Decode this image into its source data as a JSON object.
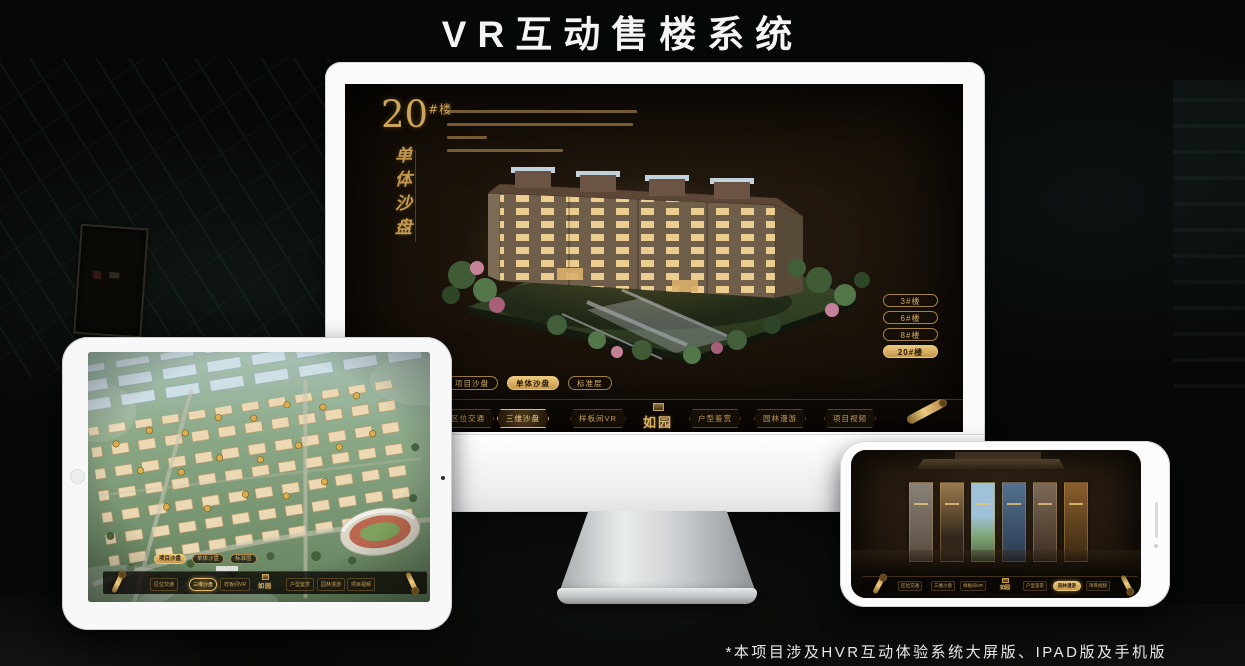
{
  "header": {
    "title": "VR互动售楼系统"
  },
  "footer": {
    "note": "*本项目涉及HVR互动体验系统大屏版、IPAD版及手机版"
  },
  "colors": {
    "gold": "#c9a158",
    "gold_bright": "#ecc87c",
    "dark_text": "#241806"
  },
  "monitor": {
    "unit_number": "20",
    "unit_suffix": "#楼",
    "vertical_title": "单体沙盘",
    "floor_buttons": [
      {
        "label": "3#楼",
        "active": false
      },
      {
        "label": "6#楼",
        "active": false
      },
      {
        "label": "8#楼",
        "active": false
      },
      {
        "label": "20#楼",
        "active": true
      }
    ],
    "mode_tabs": [
      {
        "label": "项目沙盘",
        "active": false
      },
      {
        "label": "单体沙盘",
        "active": true
      },
      {
        "label": "标准层",
        "active": false
      }
    ],
    "nav_items": [
      {
        "label": "区位交通",
        "active": false
      },
      {
        "label": "三维沙盘",
        "active": true
      },
      {
        "label": "样板间VR",
        "active": false
      },
      {
        "label": "户型鉴赏",
        "active": false
      },
      {
        "label": "园林漫游",
        "active": false
      },
      {
        "label": "项目视频",
        "active": false
      }
    ],
    "logo": "如园"
  },
  "ipad": {
    "mode_tabs": [
      {
        "label": "项目沙盘",
        "active": true
      },
      {
        "label": "单体沙盘",
        "active": false
      },
      {
        "label": "标准层",
        "active": false
      }
    ],
    "nav_items": [
      {
        "label": "区位交通",
        "active": false
      },
      {
        "label": "三维沙盘",
        "active": true
      },
      {
        "label": "样板间VR",
        "active": false
      },
      {
        "label": "户型鉴赏",
        "active": false
      },
      {
        "label": "园林漫游",
        "active": false
      },
      {
        "label": "项目视频",
        "active": false
      }
    ],
    "logo": "如园"
  },
  "phone": {
    "nav_items": [
      {
        "label": "区位交通",
        "active": false
      },
      {
        "label": "三维沙盘",
        "active": false
      },
      {
        "label": "样板间VR",
        "active": false
      },
      {
        "label": "户型鉴赏",
        "active": false
      },
      {
        "label": "园林漫游",
        "active": true
      },
      {
        "label": "项目视频",
        "active": false
      }
    ],
    "logo": "如园"
  }
}
